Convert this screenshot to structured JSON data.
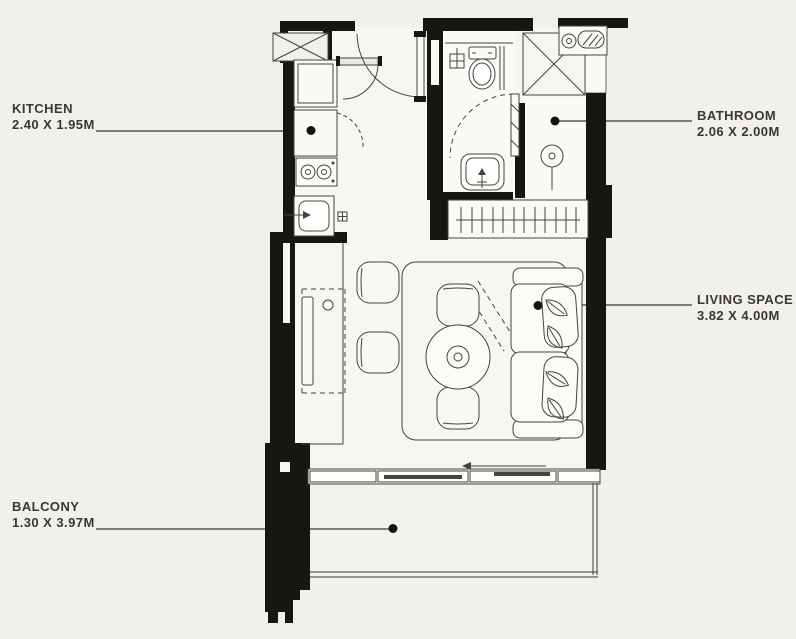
{
  "colors": {
    "background": "#f2f0ea",
    "wall": "#161613",
    "line": "#45443e",
    "text": "#3a382f",
    "floor": "#f8f7f2",
    "floor_bright": "#fbfaf7"
  },
  "rooms": {
    "kitchen": {
      "name": "KITCHEN",
      "dimensions": "2.40 X 1.95M"
    },
    "bathroom": {
      "name": "BATHROOM",
      "dimensions": "2.06 X 2.00M"
    },
    "living_space": {
      "name": "LIVING SPACE",
      "dimensions": "3.82 X 4.00M"
    },
    "balcony": {
      "name": "BALCONY",
      "dimensions": "1.30 X 3.97M"
    }
  }
}
